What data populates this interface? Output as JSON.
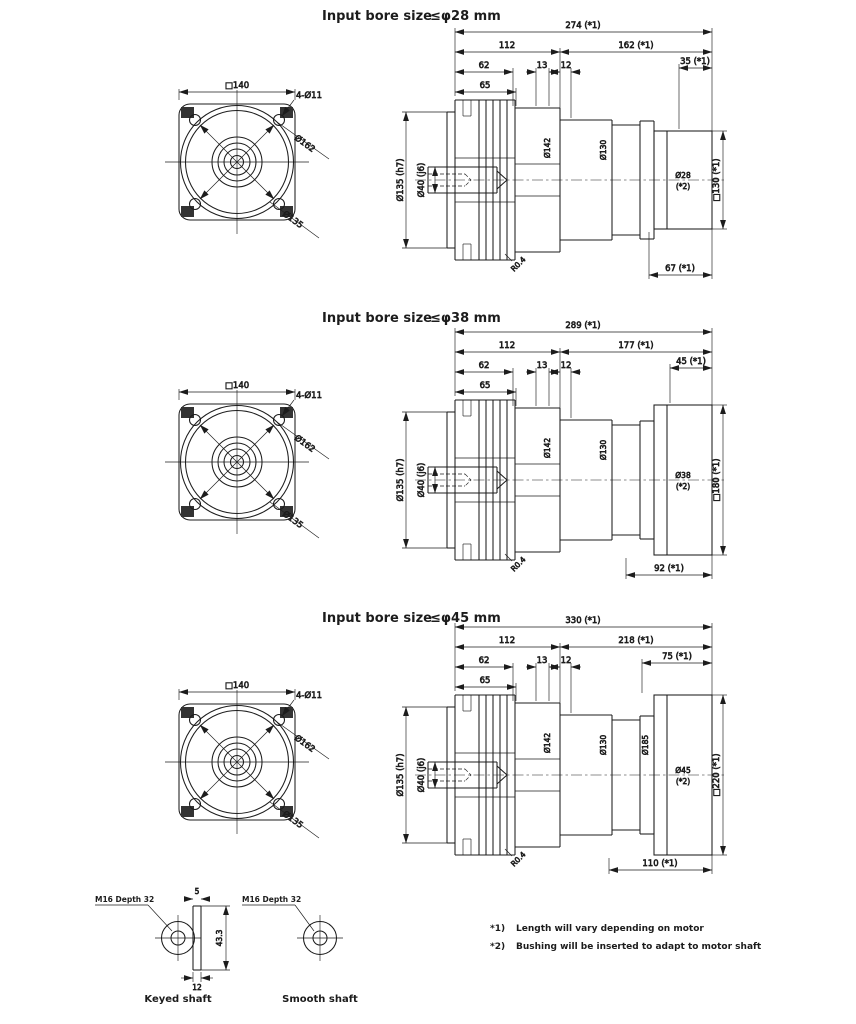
{
  "sections": [
    {
      "title_prefix": "Input bore size",
      "title_bore": "≤φ28 mm",
      "dims": {
        "total": "274 (*1)",
        "gearhead": "112",
        "motor_side": "162 (*1)",
        "flange_a": "62",
        "flange_b": "13",
        "flange_c": "12",
        "flange_d": "65",
        "adapter_right": "35 (*1)",
        "bottom": "67 (*1)",
        "motor_flange": "□130 (*1)",
        "shaft": "Ø40 (j6)",
        "pilot": "Ø135 (h7)",
        "body_1": "Ø142",
        "body_2": "Ø130",
        "input_bore": "Ø28",
        "input_bore_note": "(*2)",
        "fillet": "R0.4"
      }
    },
    {
      "title_prefix": "Input bore size",
      "title_bore": "≤φ38 mm",
      "dims": {
        "total": "289 (*1)",
        "gearhead": "112",
        "motor_side": "177 (*1)",
        "flange_a": "62",
        "flange_b": "13",
        "flange_c": "12",
        "flange_d": "65",
        "adapter_right": "45 (*1)",
        "bottom": "92 (*1)",
        "motor_flange": "□180 (*1)",
        "shaft": "Ø40 (j6)",
        "pilot": "Ø135 (h7)",
        "body_1": "Ø142",
        "body_2": "Ø130",
        "input_bore": "Ø38",
        "input_bore_note": "(*2)",
        "fillet": "R0.4"
      }
    },
    {
      "title_prefix": "Input bore size",
      "title_bore": "≤φ45 mm",
      "dims": {
        "total": "330 (*1)",
        "gearhead": "112",
        "motor_side": "218 (*1)",
        "flange_a": "62",
        "flange_b": "13",
        "flange_c": "12",
        "flange_d": "65",
        "adapter_right": "75 (*1)",
        "bottom": "110 (*1)",
        "motor_flange": "□220 (*1)",
        "shaft": "Ø40 (j6)",
        "pilot": "Ø135 (h7)",
        "body_1": "Ø142",
        "body_2": "Ø130",
        "body_3": "Ø185",
        "input_bore": "Ø45",
        "input_bore_note": "(*2)",
        "fillet": "R0.4"
      }
    }
  ],
  "front": {
    "square": "□140",
    "holes": "4-Ø11",
    "outer_dia": "Ø162",
    "pilot_dia": "Ø135"
  },
  "shaft_details": {
    "keyed_tap": "M16 Depth 32",
    "keyed_label": "Keyed shaft",
    "key_top": "5",
    "key_side": "43.3",
    "key_bottom": "12",
    "smooth_tap": "M16 Depth 32",
    "smooth_label": "Smooth shaft"
  },
  "footnotes": [
    {
      "marker": "*1)",
      "text": "Length will vary depending on motor"
    },
    {
      "marker": "*2)",
      "text": "Bushing will be inserted to adapt to motor shaft"
    }
  ]
}
